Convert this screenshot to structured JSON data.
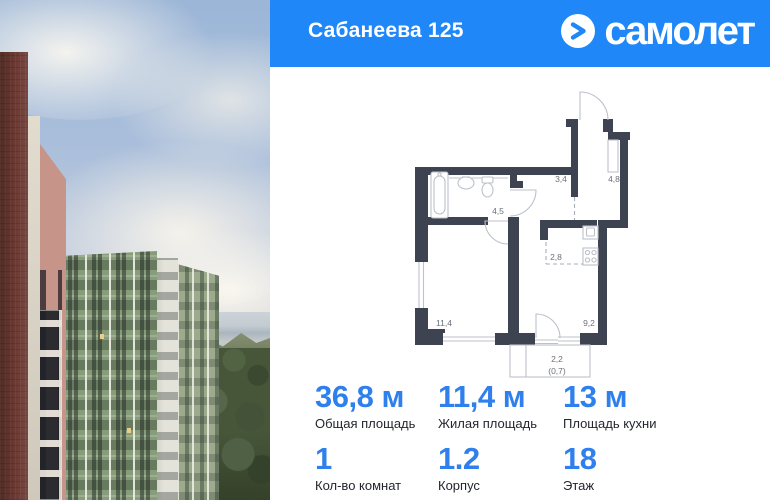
{
  "header": {
    "title": "Сабанеева 125",
    "brand": "самолет"
  },
  "colors": {
    "header_bg": "#1f87f8",
    "accent_numbers": "#2f80ed",
    "plan_wall": "#3e4351"
  },
  "floor_plan": {
    "rooms": [
      {
        "name": "hallway",
        "area": "3,4"
      },
      {
        "name": "wardrobe",
        "area": "4,8"
      },
      {
        "name": "corridor",
        "area": "4,5"
      },
      {
        "name": "kitchen-zone",
        "area": "2,8"
      },
      {
        "name": "living-room",
        "area": "11,4"
      },
      {
        "name": "room",
        "area": "9,2"
      }
    ],
    "balcony": {
      "area": "2,2",
      "reduced_area": "(0,7)"
    }
  },
  "stats": {
    "row1": [
      {
        "value": "36,8 м",
        "label": "Общая площадь"
      },
      {
        "value": "11,4 м",
        "label": "Жилая площадь"
      },
      {
        "value": "13 м",
        "label": "Площадь кухни"
      }
    ],
    "row2": [
      {
        "value": "1",
        "label": "Кол-во комнат"
      },
      {
        "value": "1.2",
        "label": "Корпус"
      },
      {
        "value": "18",
        "label": "Этаж"
      }
    ]
  }
}
